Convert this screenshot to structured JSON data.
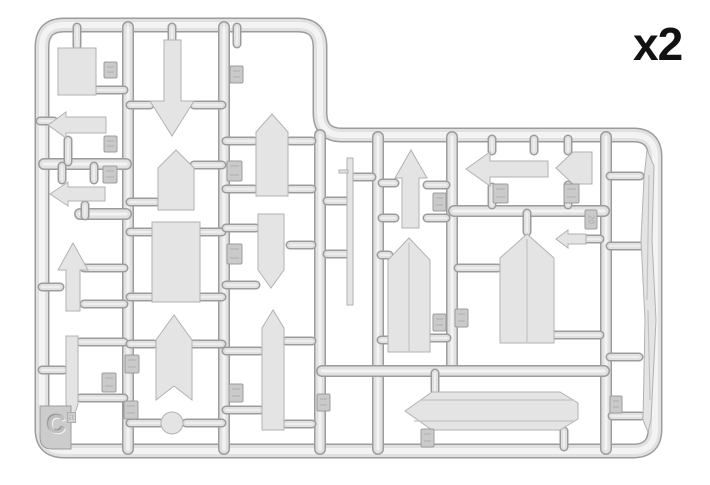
{
  "labels": {
    "quantity": "x2",
    "sprue_letter": "C",
    "sprue_letter_sub": "a"
  },
  "colors": {
    "background": "#ffffff",
    "edge": "#9c9c9c",
    "body": "#e1e1e1",
    "core": "#f3f3f3",
    "part_fill": "#e4e4e4",
    "part_edge": "#b2b2b2",
    "tab_fill": "#cacaca",
    "tab_edge": "#9c9c9c",
    "tab_mark": "#a8a8a8",
    "text": "#111111"
  },
  "frame": {
    "path": "M64,25 H298 Q320,25 320,47 V113 Q320,135 342,135 H633 Q655,135 655,157 V429 Q655,451 633,451 H64 Q42,451 42,429 V47 Q42,25 64,25 Z",
    "thickness": 15
  },
  "runners": [
    {
      "name": "runner-vertical-left",
      "d": "M128,27 V449"
    },
    {
      "name": "runner-vertical-mid",
      "d": "M224,27 V449"
    },
    {
      "name": "runner-vertical-step",
      "d": "M320,135 V449"
    },
    {
      "name": "runner-horizontal-col1-a",
      "d": "M44,164 H126"
    },
    {
      "name": "runner-horizontal-col1-b",
      "d": "M80,214 H126"
    },
    {
      "name": "runner-right-vertical-1",
      "d": "M378,137 V449"
    },
    {
      "name": "runner-right-vertical-2",
      "d": "M452,137 V369"
    },
    {
      "name": "runner-right-vertical-3",
      "d": "M606,137 V449"
    },
    {
      "name": "runner-right-horizontal-1",
      "d": "M454,211 H604"
    },
    {
      "name": "runner-right-horizontal-2",
      "d": "M322,371 H604"
    }
  ],
  "gates": [
    [
      77,
      27,
      77,
      46
    ],
    [
      96,
      90,
      124,
      90
    ],
    [
      40,
      121,
      54,
      121
    ],
    [
      68,
      140,
      68,
      162
    ],
    [
      62,
      166,
      62,
      180
    ],
    [
      94,
      166,
      94,
      180
    ],
    [
      85,
      205,
      85,
      216
    ],
    [
      42,
      287,
      60,
      287
    ],
    [
      84,
      268,
      124,
      268
    ],
    [
      84,
      304,
      124,
      304
    ],
    [
      42,
      370,
      64,
      370
    ],
    [
      80,
      342,
      124,
      342
    ],
    [
      80,
      398,
      124,
      398
    ],
    [
      130,
      423,
      160,
      423
    ],
    [
      186,
      423,
      222,
      423
    ],
    [
      172,
      27,
      172,
      40
    ],
    [
      130,
      105,
      150,
      105
    ],
    [
      194,
      105,
      222,
      105
    ],
    [
      130,
      202,
      156,
      202
    ],
    [
      194,
      165,
      222,
      165
    ],
    [
      130,
      232,
      152,
      232
    ],
    [
      200,
      232,
      222,
      232
    ],
    [
      130,
      297,
      152,
      297
    ],
    [
      200,
      297,
      222,
      297
    ],
    [
      130,
      344,
      154,
      344
    ],
    [
      192,
      344,
      222,
      344
    ],
    [
      237,
      27,
      237,
      44
    ],
    [
      226,
      141,
      254,
      141
    ],
    [
      290,
      141,
      312,
      141
    ],
    [
      226,
      189,
      254,
      189
    ],
    [
      290,
      189,
      312,
      189
    ],
    [
      226,
      228,
      256,
      228
    ],
    [
      290,
      245,
      312,
      245
    ],
    [
      226,
      285,
      256,
      285
    ],
    [
      226,
      351,
      260,
      351
    ],
    [
      286,
      341,
      312,
      341
    ],
    [
      226,
      410,
      260,
      410
    ],
    [
      286,
      424,
      312,
      424
    ],
    [
      327,
      201,
      346,
      201
    ],
    [
      327,
      254,
      346,
      254
    ],
    [
      354,
      177,
      372,
      177
    ],
    [
      382,
      183,
      395,
      183
    ],
    [
      382,
      218,
      395,
      218
    ],
    [
      427,
      185,
      446,
      185
    ],
    [
      427,
      218,
      446,
      218
    ],
    [
      492,
      139,
      492,
      151
    ],
    [
      534,
      139,
      534,
      151
    ],
    [
      492,
      187,
      492,
      205
    ],
    [
      568,
      139,
      568,
      151
    ],
    [
      568,
      185,
      568,
      205
    ],
    [
      587,
      239,
      600,
      239
    ],
    [
      381,
      255,
      389,
      255
    ],
    [
      381,
      340,
      389,
      340
    ],
    [
      431,
      338,
      447,
      338
    ],
    [
      458,
      268,
      498,
      268
    ],
    [
      555,
      335,
      600,
      335
    ],
    [
      527,
      213,
      527,
      232
    ],
    [
      435,
      373,
      435,
      391
    ],
    [
      564,
      431,
      564,
      447
    ],
    [
      610,
      176,
      640,
      176
    ],
    [
      610,
      246,
      640,
      246
    ],
    [
      610,
      357,
      639,
      357
    ],
    [
      612,
      416,
      641,
      416
    ]
  ],
  "parts": [
    {
      "name": "small-rect-sign",
      "shape": "rect",
      "x": 58,
      "y": 48,
      "w": 38,
      "h": 47
    },
    {
      "name": "arrow-sign-left-a",
      "shape": "poly",
      "pts": [
        [
          48,
          125
        ],
        [
          66,
          112
        ],
        [
          66,
          117
        ],
        [
          106,
          117
        ],
        [
          106,
          133
        ],
        [
          66,
          133
        ],
        [
          66,
          138
        ]
      ]
    },
    {
      "name": "arrow-sign-left-b",
      "shape": "poly",
      "pts": [
        [
          50,
          194
        ],
        [
          68,
          182
        ],
        [
          68,
          187
        ],
        [
          105,
          187
        ],
        [
          105,
          201
        ],
        [
          68,
          201
        ],
        [
          68,
          206
        ]
      ]
    },
    {
      "name": "arrow-sign-up-small",
      "shape": "poly",
      "pts": [
        [
          73,
          243
        ],
        [
          88,
          270
        ],
        [
          80,
          270
        ],
        [
          80,
          311
        ],
        [
          66,
          311
        ],
        [
          66,
          270
        ],
        [
          58,
          270
        ]
      ]
    },
    {
      "name": "thin-blade-post",
      "shape": "poly",
      "pts": [
        [
          66,
          336
        ],
        [
          78,
          336
        ],
        [
          78,
          404
        ],
        [
          72,
          422
        ],
        [
          66,
          404
        ]
      ]
    },
    {
      "name": "big-arrow-down",
      "shape": "poly",
      "pts": [
        [
          164,
          40
        ],
        [
          181,
          40
        ],
        [
          181,
          101
        ],
        [
          194,
          101
        ],
        [
          172,
          136
        ],
        [
          150,
          101
        ],
        [
          164,
          101
        ]
      ]
    },
    {
      "name": "pentagon-sign-small",
      "shape": "poly",
      "pts": [
        [
          158,
          168
        ],
        [
          176,
          150
        ],
        [
          194,
          168
        ],
        [
          194,
          210
        ],
        [
          158,
          210
        ]
      ]
    },
    {
      "name": "big-rect-sign",
      "shape": "rect",
      "x": 152,
      "y": 222,
      "w": 48,
      "h": 80
    },
    {
      "name": "swallowtail-banner-sign",
      "shape": "poly",
      "pts": [
        [
          156,
          340
        ],
        [
          174,
          315
        ],
        [
          192,
          340
        ],
        [
          192,
          400
        ],
        [
          174,
          386
        ],
        [
          156,
          400
        ]
      ]
    },
    {
      "name": "disc-part",
      "shape": "circle",
      "cx": 172,
      "cy": 423,
      "r": 11
    },
    {
      "name": "pentagon-sign-col3-top",
      "shape": "poly",
      "pts": [
        [
          256,
          132
        ],
        [
          272,
          114
        ],
        [
          288,
          132
        ],
        [
          288,
          196
        ],
        [
          256,
          196
        ]
      ]
    },
    {
      "name": "pentagon-sign-col3-down",
      "shape": "poly",
      "pts": [
        [
          258,
          214
        ],
        [
          284,
          214
        ],
        [
          284,
          270
        ],
        [
          271,
          288
        ],
        [
          258,
          270
        ]
      ]
    },
    {
      "name": "tall-plank-sign",
      "shape": "poly",
      "pts": [
        [
          262,
          328
        ],
        [
          273,
          310
        ],
        [
          284,
          328
        ],
        [
          284,
          430
        ],
        [
          262,
          430
        ]
      ]
    },
    {
      "name": "thin-pole",
      "shape": "rect",
      "x": 347,
      "y": 158,
      "w": 6,
      "h": 147
    },
    {
      "name": "pole-crossbar",
      "shape": "rect",
      "x": 339,
      "y": 170,
      "w": 9,
      "h": 3
    },
    {
      "name": "arrow-sign-up-shaft",
      "shape": "poly",
      "pts": [
        [
          411,
          150
        ],
        [
          427,
          178
        ],
        [
          419,
          178
        ],
        [
          419,
          228
        ],
        [
          402,
          228
        ],
        [
          402,
          178
        ],
        [
          395,
          178
        ]
      ]
    },
    {
      "name": "long-arrow-sign-left",
      "shape": "poly",
      "pts": [
        [
          466,
          169
        ],
        [
          490,
          152
        ],
        [
          490,
          161
        ],
        [
          548,
          161
        ],
        [
          548,
          177
        ],
        [
          490,
          177
        ],
        [
          490,
          186
        ]
      ]
    },
    {
      "name": "pennant-arrow-sign",
      "shape": "poly",
      "pts": [
        [
          556,
          168
        ],
        [
          573,
          152
        ],
        [
          592,
          152
        ],
        [
          592,
          184
        ],
        [
          573,
          184
        ]
      ]
    },
    {
      "name": "small-arrow-left",
      "shape": "poly",
      "pts": [
        [
          556,
          239
        ],
        [
          568,
          230
        ],
        [
          568,
          234
        ],
        [
          586,
          234
        ],
        [
          586,
          244
        ],
        [
          568,
          244
        ],
        [
          568,
          248
        ]
      ]
    },
    {
      "name": "tall-pentagon-sign-a",
      "shape": "poly",
      "pts": [
        [
          388,
          260
        ],
        [
          409,
          238
        ],
        [
          430,
          260
        ],
        [
          430,
          352
        ],
        [
          388,
          352
        ]
      ],
      "lines": [
        [
          [
            409,
            243
          ],
          [
            409,
            351
          ]
        ]
      ]
    },
    {
      "name": "tall-pentagon-sign-b",
      "shape": "poly",
      "pts": [
        [
          500,
          258
        ],
        [
          527,
          234
        ],
        [
          554,
          258
        ],
        [
          554,
          343
        ],
        [
          500,
          343
        ]
      ],
      "lines": [
        [
          [
            527,
            239
          ],
          [
            527,
            342
          ]
        ]
      ]
    },
    {
      "name": "long-plank-sign",
      "shape": "poly",
      "pts": [
        [
          405,
          411
        ],
        [
          432,
          392
        ],
        [
          560,
          392
        ],
        [
          578,
          403
        ],
        [
          578,
          419
        ],
        [
          560,
          430
        ],
        [
          432,
          430
        ]
      ],
      "lines": [
        [
          [
            420,
            400
          ],
          [
            574,
            400
          ]
        ],
        [
          [
            414,
            421
          ],
          [
            574,
            421
          ]
        ]
      ]
    },
    {
      "name": "wood-post",
      "shape": "poly",
      "pts": [
        [
          647,
          150
        ],
        [
          654,
          166
        ],
        [
          652,
          240
        ],
        [
          656,
          320
        ],
        [
          651,
          420
        ],
        [
          648,
          432
        ],
        [
          643,
          420
        ],
        [
          645,
          320
        ],
        [
          641,
          240
        ],
        [
          644,
          178
        ]
      ],
      "lines": [
        [
          [
            649,
            175
          ],
          [
            647,
            300
          ]
        ],
        [
          [
            648,
            310
          ],
          [
            650,
            400
          ]
        ]
      ]
    }
  ],
  "tabs": [
    {
      "x": 104,
      "y": 62,
      "w": 13,
      "h": 16,
      "label": ""
    },
    {
      "x": 104,
      "y": 136,
      "w": 13,
      "h": 16,
      "label": ""
    },
    {
      "x": 103,
      "y": 166,
      "w": 14,
      "h": 17,
      "label": ""
    },
    {
      "x": 230,
      "y": 66,
      "w": 13,
      "h": 17,
      "label": ""
    },
    {
      "x": 227,
      "y": 161,
      "w": 15,
      "h": 20,
      "label": ""
    },
    {
      "x": 227,
      "y": 244,
      "w": 15,
      "h": 20,
      "label": ""
    },
    {
      "x": 125,
      "y": 355,
      "w": 14,
      "h": 18,
      "label": ""
    },
    {
      "x": 124,
      "y": 401,
      "w": 14,
      "h": 18,
      "label": ""
    },
    {
      "x": 102,
      "y": 373,
      "w": 14,
      "h": 19,
      "label": ""
    },
    {
      "x": 229,
      "y": 384,
      "w": 14,
      "h": 18,
      "label": ""
    },
    {
      "x": 317,
      "y": 394,
      "w": 13,
      "h": 17,
      "label": ""
    },
    {
      "x": 433,
      "y": 193,
      "w": 13,
      "h": 18,
      "label": ""
    },
    {
      "x": 493,
      "y": 184,
      "w": 15,
      "h": 19,
      "label": ""
    },
    {
      "x": 564,
      "y": 184,
      "w": 15,
      "h": 19,
      "label": ""
    },
    {
      "x": 585,
      "y": 210,
      "w": 12,
      "h": 19,
      "label": "20"
    },
    {
      "x": 433,
      "y": 314,
      "w": 13,
      "h": 17,
      "label": ""
    },
    {
      "x": 455,
      "y": 309,
      "w": 13,
      "h": 18,
      "label": ""
    },
    {
      "x": 421,
      "y": 429,
      "w": 13,
      "h": 18,
      "label": ""
    },
    {
      "x": 610,
      "y": 396,
      "w": 12,
      "h": 17,
      "label": ""
    }
  ],
  "corner_tab": {
    "x": 40,
    "y": 406,
    "w": 31,
    "h": 43
  }
}
